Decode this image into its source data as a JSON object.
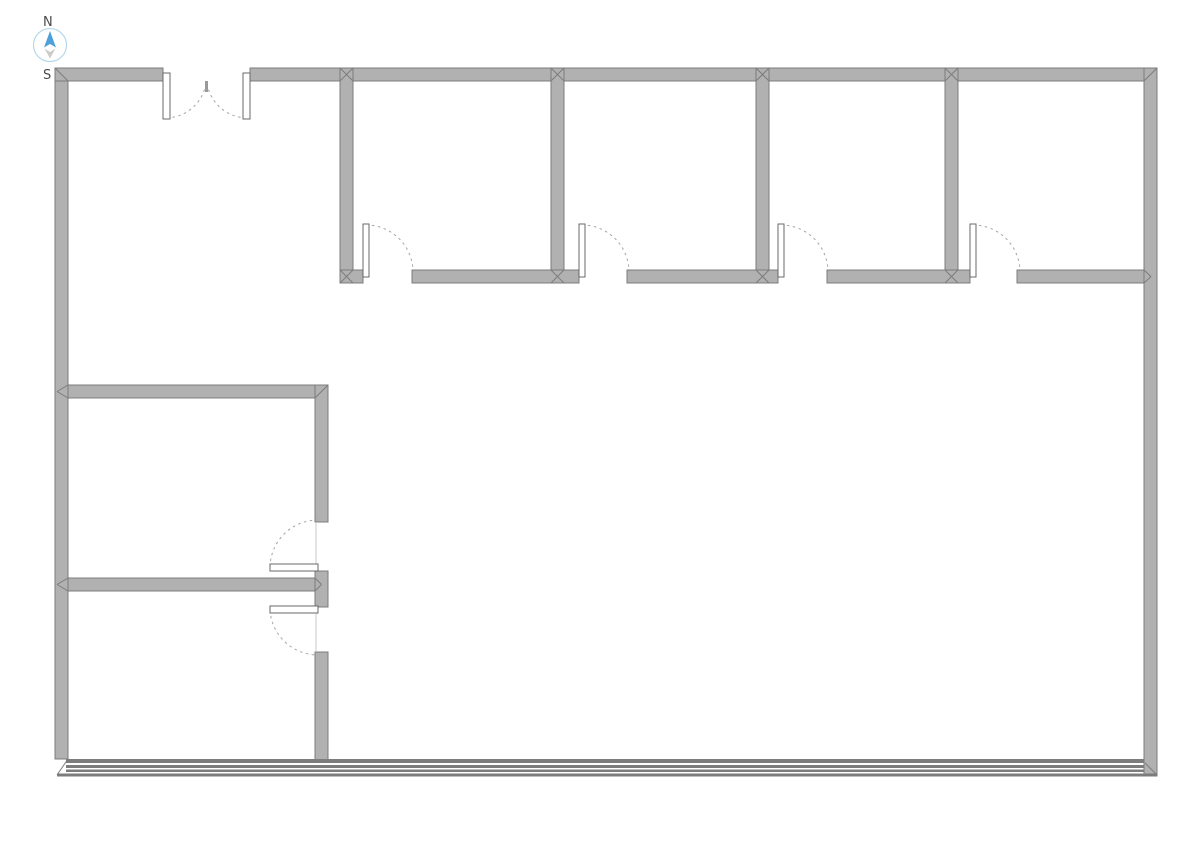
{
  "compass": {
    "north_label": "N",
    "south_label": "S",
    "circle": {
      "cx": 50,
      "cy": 45,
      "r": 16.5
    },
    "needle_north_points": "50,31 44,47.5 50,44 56,47.5",
    "needle_south_points": "44.5,48.5 50,52 55.5,48.5 50,58.5",
    "colors": {
      "circle_stroke": "#b5d9ec",
      "needle_north": "#4da0d8",
      "needle_south": "#cbcbcb",
      "label": "#4a4a4a"
    }
  },
  "plan": {
    "colors": {
      "background": "#ffffff",
      "wall_fill": "#b1b1b1",
      "wall_stroke": "#7c7c7c",
      "door_fill": "#ffffff",
      "door_stroke": "#686868",
      "arc": "#a6a6a6",
      "face_line": "#c8c8c8",
      "band_line": "#7c7c7c",
      "marker": "#999999"
    },
    "walls": [
      {
        "name": "west-exterior-wall",
        "rect": [
          55,
          68,
          13,
          691
        ]
      },
      {
        "name": "north-wall-left-segment",
        "rect": [
          55,
          68,
          108,
          13
        ]
      },
      {
        "name": "north-wall-main-segment",
        "rect": [
          250,
          68,
          907,
          13
        ]
      },
      {
        "name": "east-exterior-wall",
        "rect": [
          1144,
          68,
          13,
          708
        ]
      },
      {
        "name": "top-rooms-end-wall",
        "rect": [
          340,
          68,
          13,
          215
        ]
      },
      {
        "name": "top-rooms-divider-1",
        "rect": [
          551,
          68,
          13,
          215
        ]
      },
      {
        "name": "top-rooms-divider-2",
        "rect": [
          756,
          68,
          13,
          215
        ]
      },
      {
        "name": "top-rooms-divider-3",
        "rect": [
          945,
          68,
          13,
          215
        ]
      },
      {
        "name": "top-rooms-south-wall-a",
        "rect": [
          340,
          270,
          23,
          13
        ]
      },
      {
        "name": "top-rooms-south-wall-b",
        "rect": [
          412,
          270,
          167,
          13
        ]
      },
      {
        "name": "top-rooms-south-wall-c",
        "rect": [
          627,
          270,
          151,
          13
        ]
      },
      {
        "name": "top-rooms-south-wall-d",
        "rect": [
          827,
          270,
          143,
          13
        ]
      },
      {
        "name": "top-rooms-south-wall-e",
        "rect": [
          1017,
          270,
          127,
          13
        ]
      },
      {
        "name": "left-room-north-wall",
        "rect": [
          68,
          385,
          260,
          13
        ]
      },
      {
        "name": "left-rooms-east-wall-upper",
        "rect": [
          315,
          385,
          13,
          137
        ]
      },
      {
        "name": "left-rooms-east-wall-stub",
        "rect": [
          315,
          571,
          13,
          36
        ]
      },
      {
        "name": "left-rooms-divider-wall",
        "rect": [
          68,
          578,
          247,
          13
        ]
      },
      {
        "name": "left-rooms-east-wall-lower",
        "rect": [
          315,
          652,
          13,
          108
        ]
      }
    ],
    "miters": [
      [
        55,
        68,
        68,
        81
      ],
      [
        1157,
        68,
        1144,
        81
      ],
      [
        57,
        775,
        68,
        759
      ],
      [
        1157,
        775,
        1145,
        763
      ],
      [
        340,
        68,
        353,
        81
      ],
      [
        353,
        68,
        340,
        81
      ],
      [
        551,
        68,
        564,
        81
      ],
      [
        564,
        68,
        551,
        81
      ],
      [
        756,
        68,
        769,
        81
      ],
      [
        769,
        68,
        756,
        81
      ],
      [
        945,
        68,
        958,
        81
      ],
      [
        958,
        68,
        945,
        81
      ],
      [
        340,
        270,
        353,
        283
      ],
      [
        353,
        270,
        340,
        283
      ],
      [
        551,
        270,
        564,
        283
      ],
      [
        564,
        270,
        551,
        283
      ],
      [
        756,
        270,
        769,
        283
      ],
      [
        769,
        270,
        756,
        283
      ],
      [
        945,
        270,
        958,
        283
      ],
      [
        958,
        270,
        945,
        283
      ],
      [
        1144,
        270,
        1151,
        276.5
      ],
      [
        1144,
        283,
        1151,
        276.5
      ],
      [
        68,
        385,
        57,
        391.5
      ],
      [
        68,
        398,
        57,
        391.5
      ],
      [
        68,
        578,
        57,
        584.5
      ],
      [
        68,
        591,
        57,
        584.5
      ],
      [
        328,
        385,
        315,
        398
      ],
      [
        315,
        578,
        321.5,
        584.5
      ],
      [
        315,
        591,
        321.5,
        584.5
      ]
    ],
    "face_lines": [
      [
        316,
        522,
        316,
        569
      ],
      [
        316,
        610,
        316,
        652
      ]
    ],
    "bottom_band": {
      "name": "south-window-wall",
      "lines": [
        [
          66,
          759,
          1078,
          4
        ],
        [
          66,
          765,
          1078,
          3
        ],
        [
          66,
          769.5,
          1078,
          2.5
        ],
        [
          57,
          773.5,
          1100,
          3
        ]
      ]
    },
    "doors": [
      {
        "name": "top-room-1-door",
        "panel": [
          363,
          224,
          6,
          53
        ],
        "arc": "M366,225 A47,47 0 0 1 413,272"
      },
      {
        "name": "top-room-2-door",
        "panel": [
          579,
          224,
          6,
          53
        ],
        "arc": "M582,225 A47,47 0 0 1 629,272"
      },
      {
        "name": "top-room-3-door",
        "panel": [
          778,
          224,
          6,
          53
        ],
        "arc": "M781,225 A47,47 0 0 1 828,272"
      },
      {
        "name": "top-room-4-door",
        "panel": [
          970,
          224,
          6,
          53
        ],
        "arc": "M973,225 A47,47 0 0 1 1020,272"
      },
      {
        "name": "left-upper-room-door",
        "panel": [
          270,
          564,
          48,
          7
        ],
        "arc": "M270,567 A48,48 0 0 1 318,520"
      },
      {
        "name": "left-lower-room-door",
        "panel": [
          270,
          606,
          48,
          7
        ],
        "arc": "M270,610 A48,48 0 0 0 318,655"
      },
      {
        "name": "entrance-double-door-left-leaf",
        "panel": [
          163,
          73,
          7,
          46
        ],
        "arc": "M166.5,118 A41,41 0 0 0 206,83"
      },
      {
        "name": "entrance-double-door-right-leaf",
        "panel": [
          243,
          73,
          7,
          46
        ],
        "arc": "M246.5,118 A41,41 0 0 1 207,83"
      }
    ],
    "door_meet_marker": [
      205,
      81,
      3,
      11
    ]
  }
}
